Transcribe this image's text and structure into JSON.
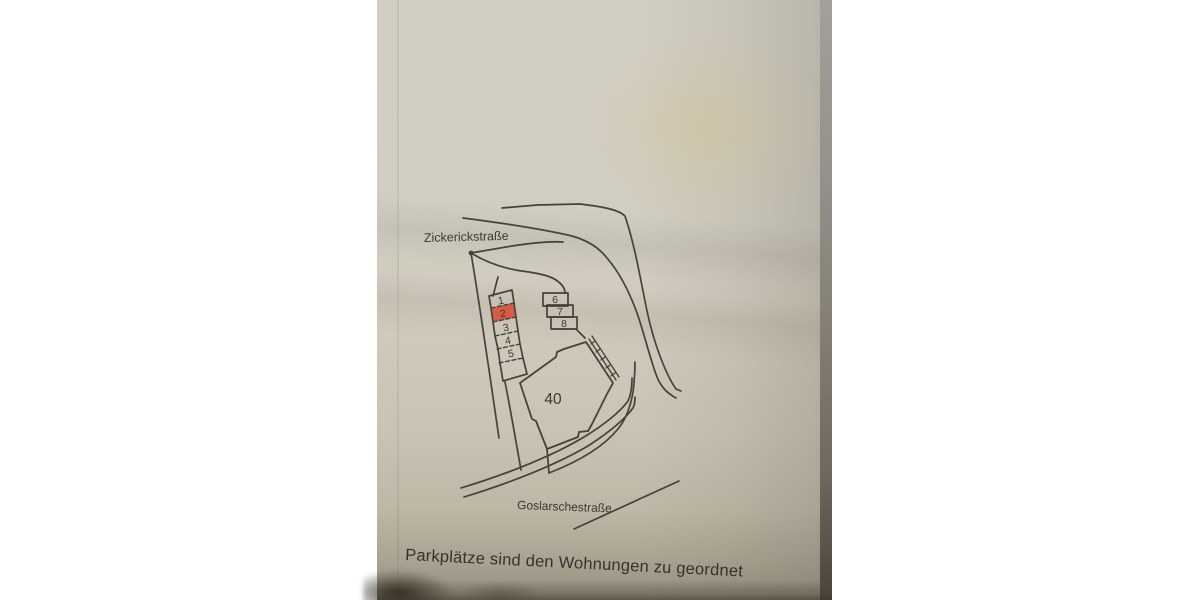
{
  "photo": {
    "plan": {
      "street_top_label": "Zickerickstraße",
      "street_bottom_label": "Goslarschestraße",
      "building_label": "40",
      "parking_spaces_left": [
        "1",
        "2",
        "3",
        "4",
        "5"
      ],
      "parking_spaces_right": [
        "6",
        "7",
        "8"
      ],
      "highlighted_space": "2",
      "highlight_color": "#d85b46",
      "ink_color": "#45423a"
    },
    "caption": "Parkplätze sind den Wohnungen zu geordnet",
    "paper_color": "#d1cdc1"
  }
}
